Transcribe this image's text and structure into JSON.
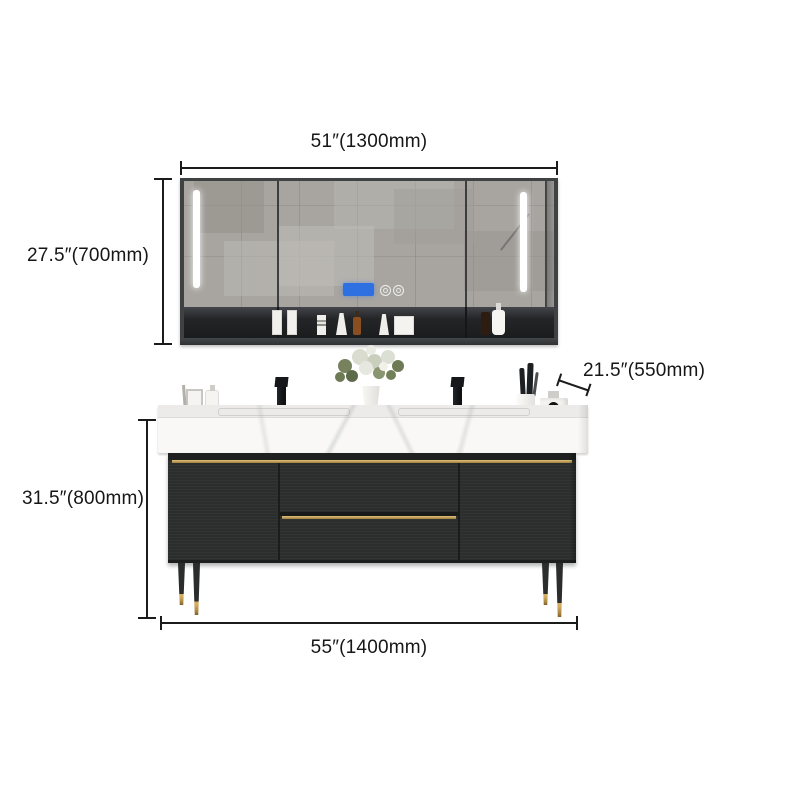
{
  "page": {
    "background": "#ffffff",
    "type": "product-dimension-diagram"
  },
  "annotations": {
    "mirror_width": {
      "label": "51″(1300mm)"
    },
    "mirror_height": {
      "label": "27.5″(700mm)"
    },
    "counter_depth": {
      "label": "21.5″(550mm)"
    },
    "vanity_height": {
      "label": "31.5″(800mm)"
    },
    "vanity_width": {
      "label": "55″(1400mm)"
    }
  },
  "product": {
    "mirror_cabinet": {
      "doors": 3,
      "led_strips": 2,
      "smart_display_color": "#2e6fe2",
      "frame_color": "#3f4243",
      "shelf_items": [
        "cosmetic-box",
        "cosmetic-box",
        "striped-jar",
        "cream-tube",
        "amber-dropper-bottle",
        "cream-tube",
        "cosmetic-card-box",
        "amber-bottle",
        "pump-bottle"
      ]
    },
    "vanity": {
      "counter_color": "#f9f8f6",
      "cabinet_color": "#2c2e2d",
      "gold_accent_color": "#c2a057",
      "faucets": 2,
      "legs": 4,
      "leg_tip_color": "#b08d43"
    },
    "decor": [
      "flower-vase",
      "vanity-tray",
      "soap-dispenser",
      "brush-cup",
      "perfume-bottle"
    ]
  }
}
